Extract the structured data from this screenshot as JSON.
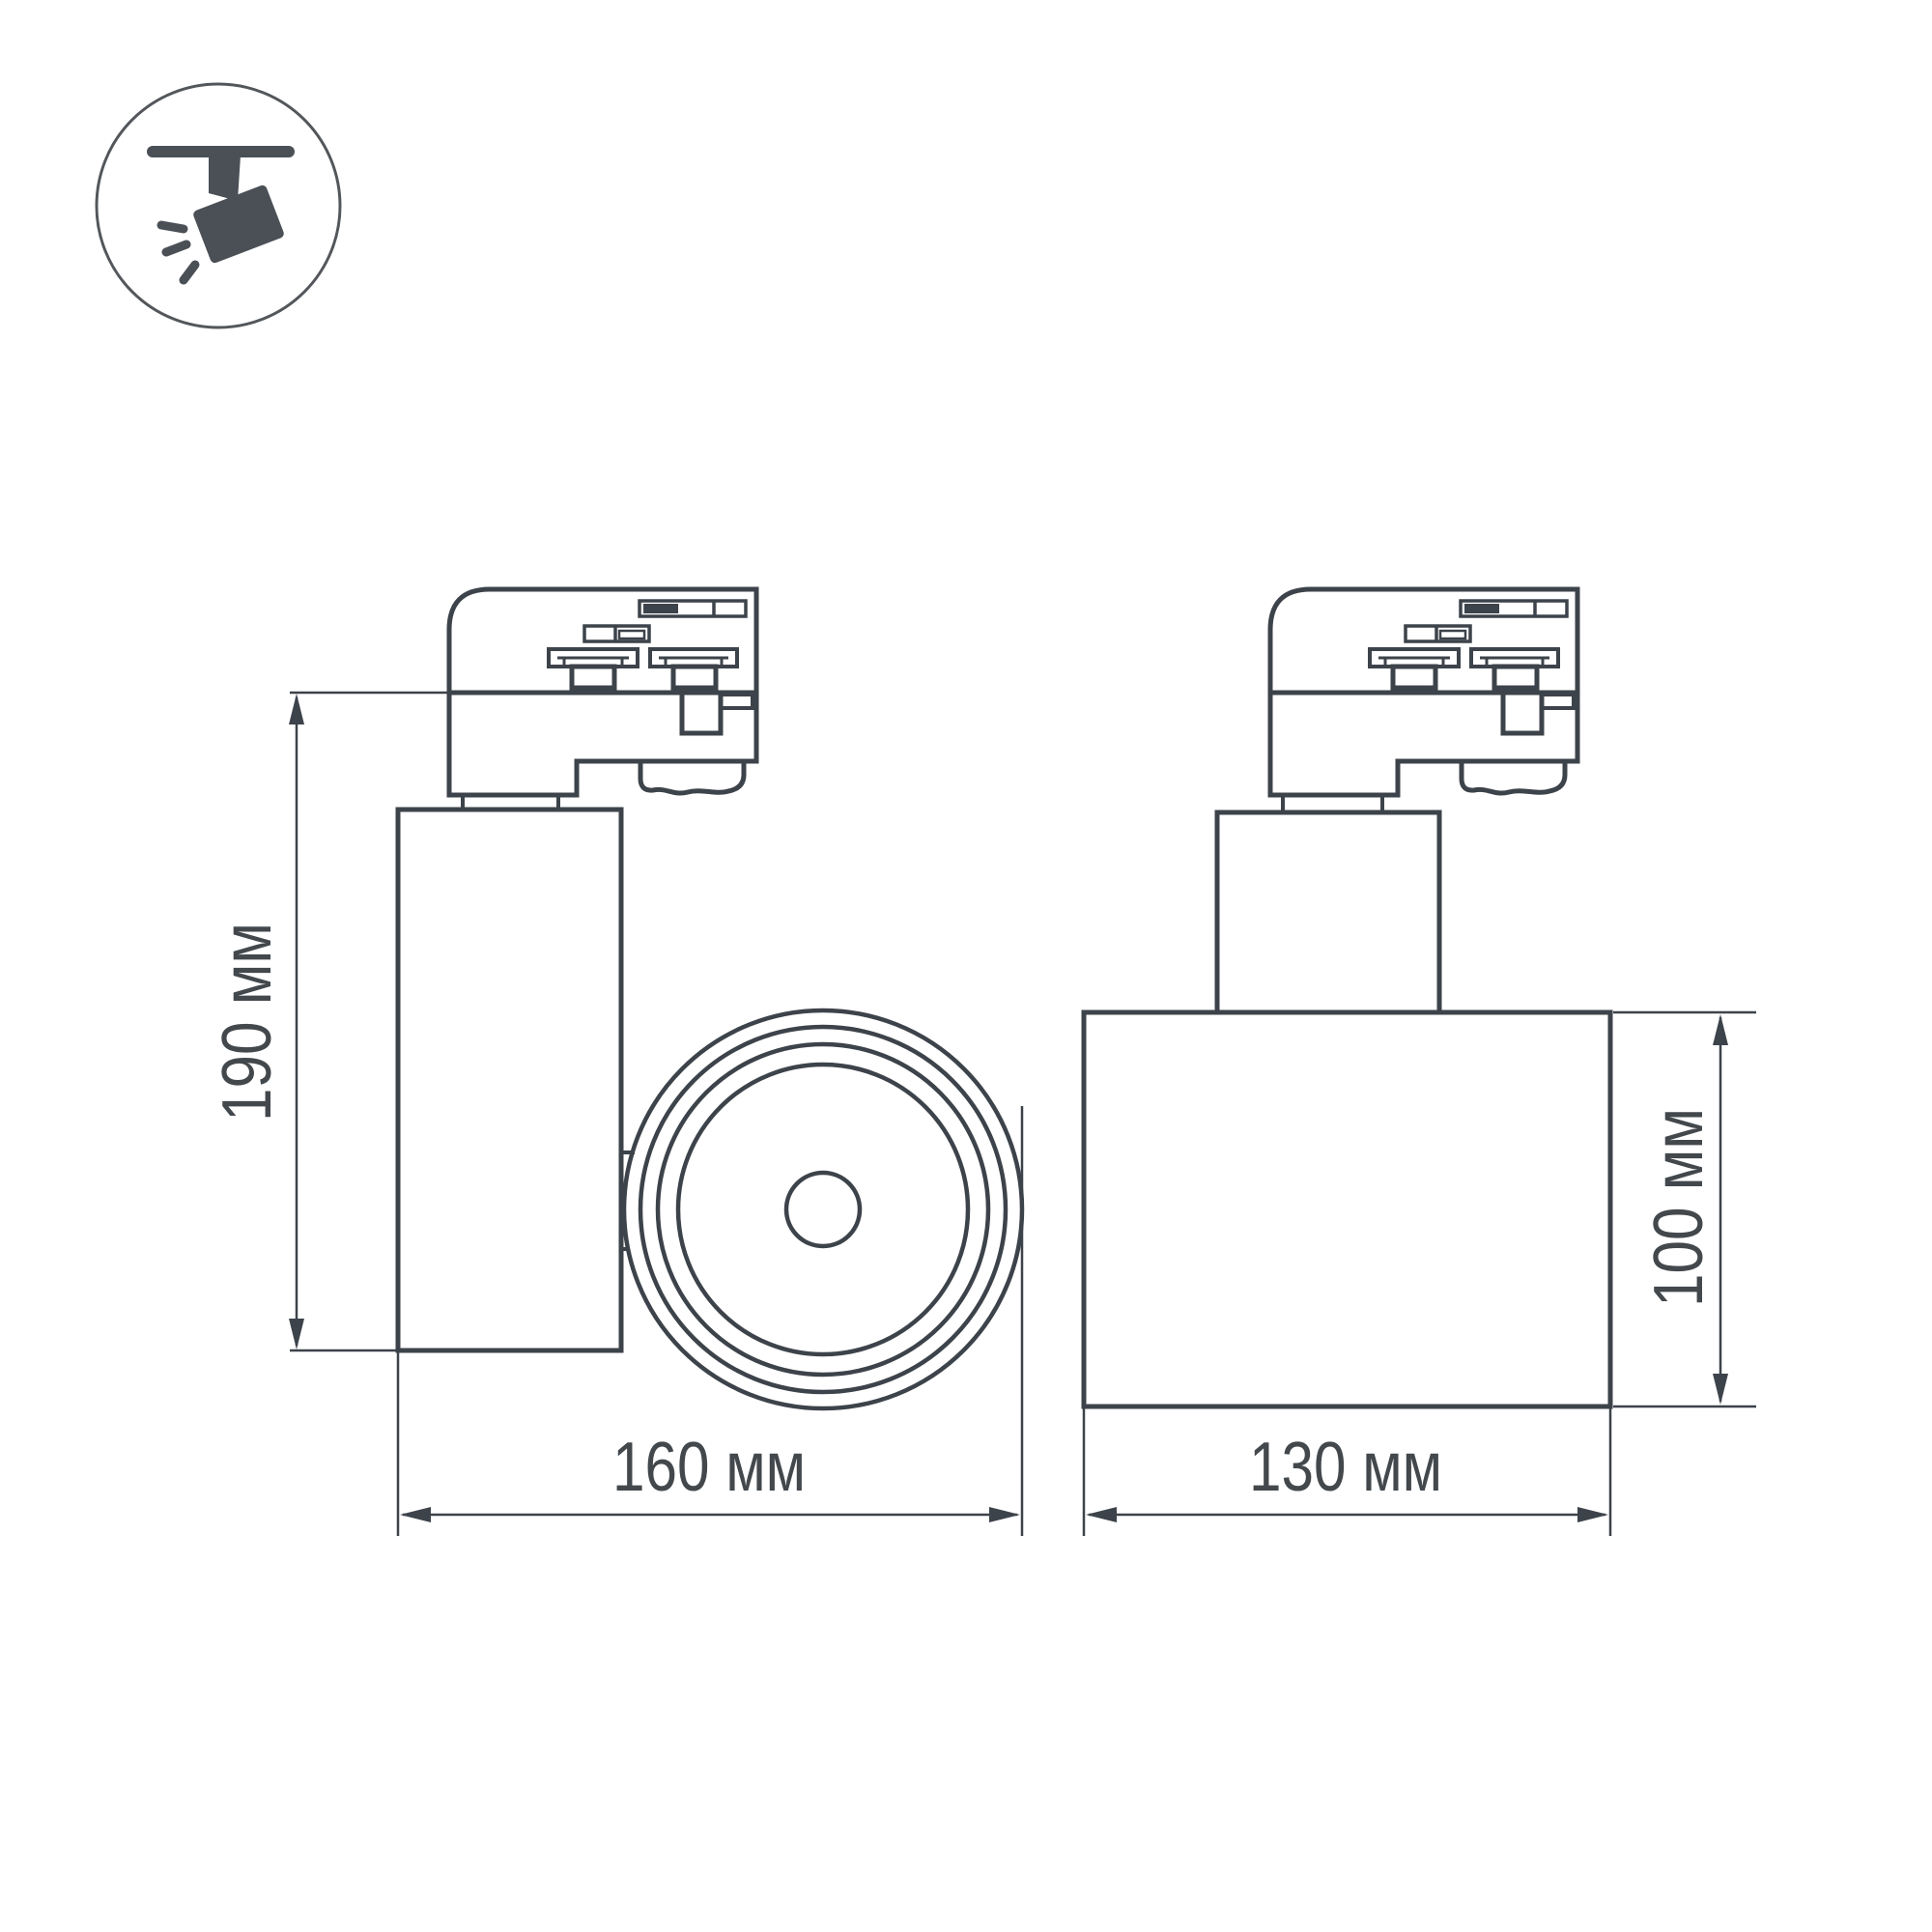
{
  "page": {
    "background": "#ffffff"
  },
  "icon": {
    "name": "ceiling-track-spotlight",
    "glyph_color": "#4a5056",
    "ring_color": "#53575b"
  },
  "drawing": {
    "line_color": "#3d434a",
    "text_color": "#43484d",
    "views": [
      {
        "id": "front-view",
        "parts": [
          "track-adapter",
          "cylinder-body",
          "round-lamp-head"
        ]
      },
      {
        "id": "side-view",
        "parts": [
          "track-adapter",
          "neck",
          "lamp-body"
        ]
      }
    ],
    "dimensions": {
      "height": {
        "label": "190 мм",
        "value_mm": 190
      },
      "width": {
        "label": "160 мм",
        "value_mm": 160
      },
      "body_width": {
        "label": "130 мм",
        "value_mm": 130
      },
      "body_height": {
        "label": "100 мм",
        "value_mm": 100
      }
    }
  }
}
